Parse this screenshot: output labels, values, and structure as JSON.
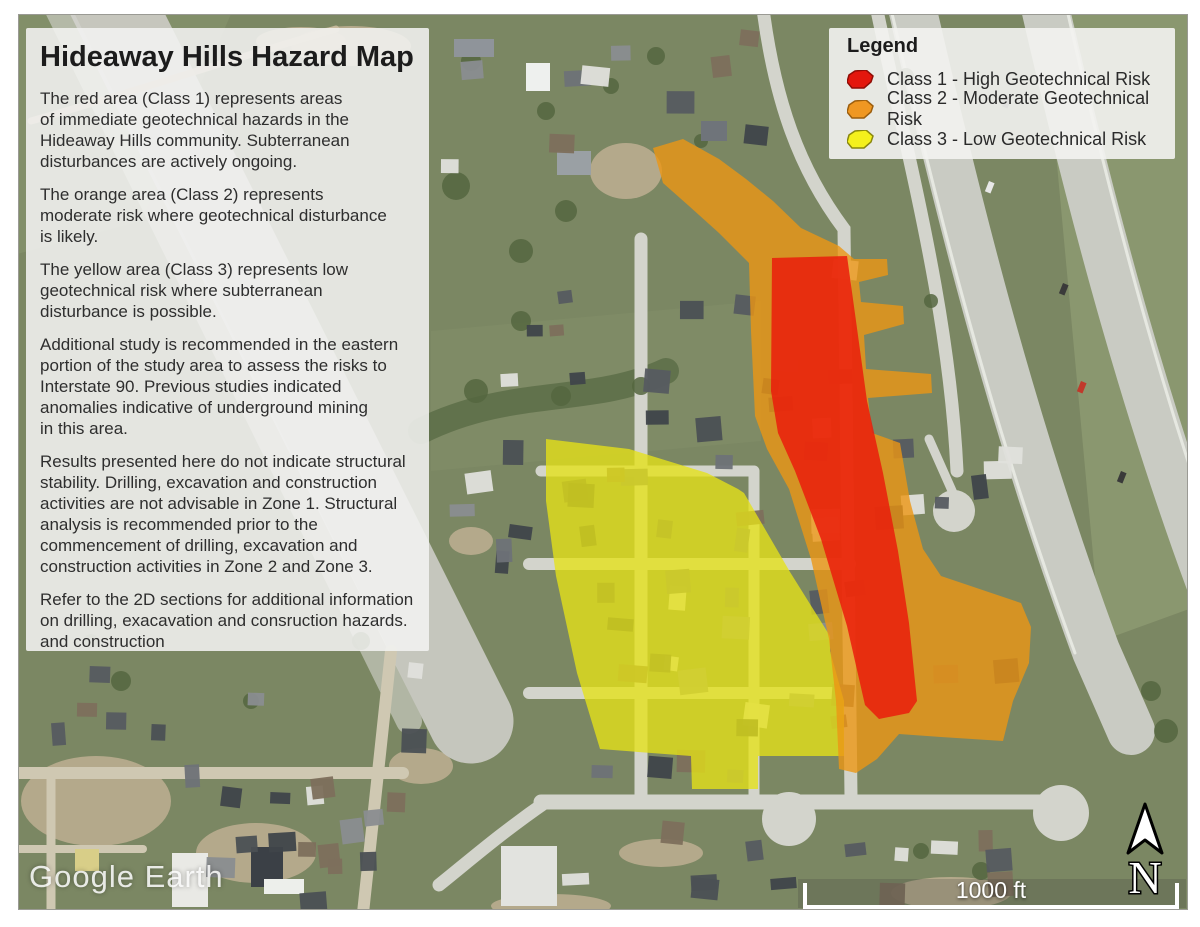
{
  "panel": {
    "title": "Hideaway Hills Hazard Map",
    "paragraphs": [
      "The red area (Class 1) represents areas\nof immediate geotechnical hazards in the\nHideaway Hills community. Subterranean\ndisturbances are actively ongoing.",
      "The orange area (Class 2) represents\nmoderate risk where geotechnical disturbance\nis likely.",
      "The yellow area (Class 3) represents low\ngeotechnical risk where subterranean\ndisturbance is possible.",
      "Additional study is recommended in the eastern\nportion of the study area to assess the risks to\nInterstate 90. Previous studies indicated\nanomalies indicative of underground mining\nin this area.",
      "Results presented here do not indicate structural\nstability. Drilling, excavation and construction\nactivities are not advisable in Zone 1. Structural\nanalysis is recommended prior to the\ncommencement of drilling, excavation and\nconstruction activities in Zone 2 and Zone 3.",
      "Refer to the 2D sections for additional information\non drilling, exacavation and consruction hazards.\nand construction"
    ]
  },
  "legend": {
    "title": "Legend",
    "items": [
      {
        "label": "Class 1 - High Geotechnical Risk",
        "swatch_color": "#e3170d",
        "swatch_border": "#8f0d06"
      },
      {
        "label": "Class 2 - Moderate Geotechnical Risk",
        "swatch_color": "#ef9722",
        "swatch_border": "#9c5e0e"
      },
      {
        "label": "Class 3 - Low Geotechnical Risk",
        "swatch_color": "#f4f01c",
        "swatch_border": "#8a880e"
      }
    ]
  },
  "watermark": {
    "text": "Google Earth"
  },
  "scale_bar": {
    "label": "1000 ft"
  },
  "north": {
    "label": "N"
  },
  "zones": [
    {
      "name": "class-3-low-risk",
      "label": "Class 3 - Low Geotechnical Risk",
      "color": "#e6e217",
      "opacity": 0.78,
      "points": "545,438 628,448 706,472 737,488 743,492 789,571 829,635 829,650 843,700 843,755 757,755 757,788 691,788 690,755 599,748 576,672 555,575 545,500"
    },
    {
      "name": "class-2-moderate-risk",
      "label": "Class 2 - Moderate Geotechnical Risk",
      "color": "#ec9614",
      "opacity": 0.8,
      "points": "652,147 682,138 718,158 745,178 772,200 800,227 838,245 853,258 886,258 887,274 858,281 860,301 902,305 903,323 863,334 865,368 930,373 931,392 867,397 871,432 899,442 909,500 922,548 940,575 1020,602 1030,626 1028,662 1012,700 1002,740 940,736 898,733 876,758 855,772 838,768 835,700 828,638 810,558 788,488 766,448 754,415 750,330 748,262 718,232 688,205 662,182"
    },
    {
      "name": "class-1-high-risk",
      "label": "Class 1 - High Geotechnical Risk",
      "color": "#ea1c0c",
      "opacity": 0.85,
      "points": "771,257 846,255 855,320 866,400 882,472 897,550 908,622 916,700 908,712 878,718 864,704 846,625 820,538 794,470 777,432 770,390"
    }
  ]
}
